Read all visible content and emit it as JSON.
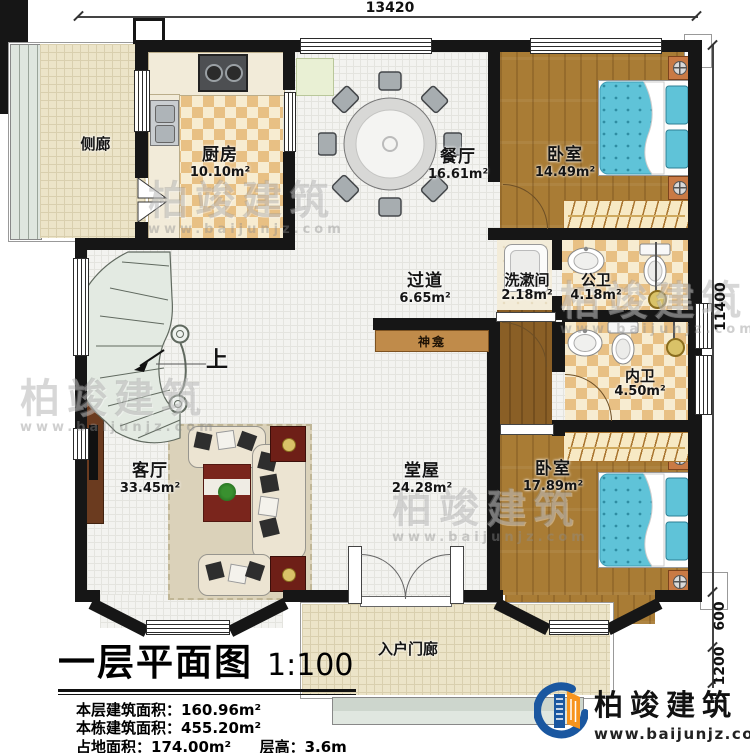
{
  "dimensions": {
    "top": "13420",
    "right_main": "11400",
    "right_step": "600",
    "right_porch": "1200"
  },
  "rooms": {
    "side_corridor": {
      "label": "侧廊"
    },
    "kitchen": {
      "label": "厨房",
      "area": "10.10m²"
    },
    "dining": {
      "label": "餐厅",
      "area": "16.61m²"
    },
    "bedroom1": {
      "label": "卧室",
      "area": "14.49m²"
    },
    "hallway": {
      "label": "过道",
      "area": "6.65m²"
    },
    "washroom": {
      "label": "洗漱间",
      "area": "2.18m²"
    },
    "public_bath": {
      "label": "公卫",
      "area": "4.18m²"
    },
    "private_bath": {
      "label": "内卫",
      "area": "4.50m²"
    },
    "shrine": {
      "label": "神龛"
    },
    "living": {
      "label": "客厅",
      "area": "33.45m²"
    },
    "main_hall": {
      "label": "堂屋",
      "area": "24.28m²"
    },
    "bedroom2": {
      "label": "卧室",
      "area": "17.89m²"
    },
    "entry_porch": {
      "label": "入户门廊"
    },
    "stairs_up": {
      "label": "上"
    }
  },
  "title_block": {
    "title": "一层平面图",
    "scale": "1:100",
    "lines": [
      {
        "label": "本层建筑面积：",
        "value": "160.96m²"
      },
      {
        "label": "本栋建筑面积：",
        "value": "455.20m²"
      },
      {
        "label": "占地面积：",
        "value": "174.00m²",
        "label2": "层高：",
        "value2": "3.6m"
      }
    ]
  },
  "brand": {
    "name": "柏竣建筑",
    "url": "www.baijunjz.com"
  },
  "watermark": {
    "text": "柏竣建筑",
    "url": "www.baijunjz.com"
  },
  "colors": {
    "wall": "#161616",
    "mattress": "#5fc3d8",
    "wood": "#a97c35",
    "checker": "#e8c084",
    "brand_blue": "#1a57a0",
    "brand_orange": "#f7941d"
  }
}
